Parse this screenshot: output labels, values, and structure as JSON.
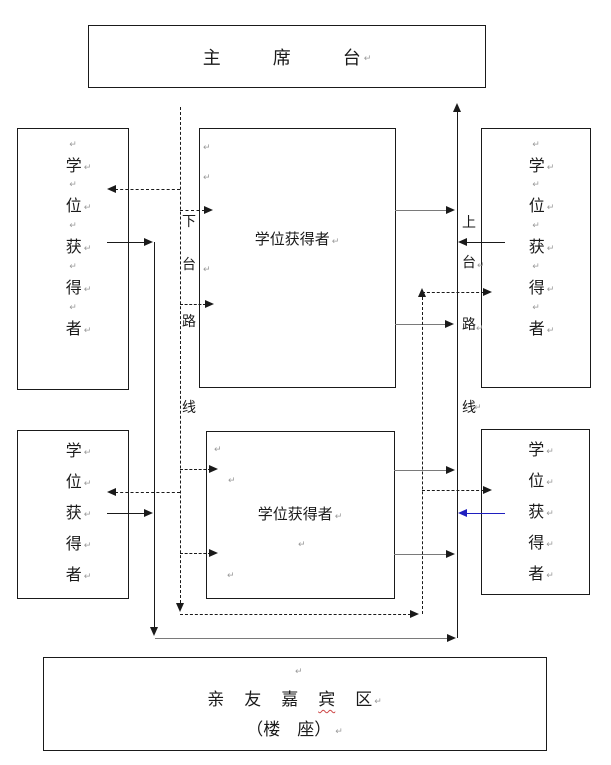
{
  "marks": {
    "pilcrow": "↵"
  },
  "colors": {
    "outline": "#1a1a1a",
    "blue_arrow": "#1f1fbf",
    "pilcrow_gray": "#9a9a9a",
    "spellcheck_red": "#cc4444"
  },
  "stage_box": {
    "chars": [
      "主",
      "席",
      "台"
    ]
  },
  "degree_holder_vertical_chars": [
    "学",
    "位",
    "获",
    "得",
    "者"
  ],
  "center_boxes": {
    "top_label": "学位获得者",
    "bottom_label": "学位获得者"
  },
  "exit_route_label": {
    "chars": [
      "下",
      "台",
      "路",
      "线"
    ]
  },
  "entry_route_label": {
    "chars": [
      "上",
      "台",
      "路",
      "线"
    ]
  },
  "guest_box": {
    "line1_chars": [
      "亲",
      "友",
      "嘉",
      "宾",
      "区"
    ],
    "line2": "（楼　座）"
  }
}
